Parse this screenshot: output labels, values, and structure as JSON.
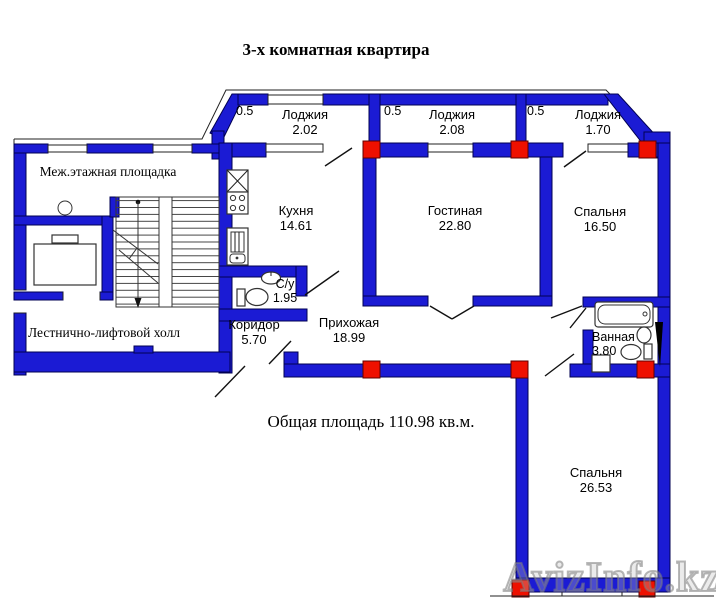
{
  "title": "3-х комнатная квартира",
  "total_area_text": "Общая площадь 110.98 кв.м.",
  "watermark": "AvizInfo.kz",
  "colors": {
    "wall": "#1b1bd4",
    "wall_border": "#000052",
    "column_marker": "#ee1000",
    "background": "#ffffff"
  },
  "rooms": {
    "lodzhia1": {
      "name": "Лоджия",
      "area": "2.02",
      "parapet": "0.5"
    },
    "lodzhia2": {
      "name": "Лоджия",
      "area": "2.08",
      "parapet": "0.5"
    },
    "lodzhia3": {
      "name": "Лоджия",
      "area": "1.70",
      "parapet": "0.5"
    },
    "kitchen": {
      "name": "Кухня",
      "area": "14.61"
    },
    "living": {
      "name": "Гостиная",
      "area": "22.80"
    },
    "bedroom1": {
      "name": "Спальня",
      "area": "16.50"
    },
    "wc": {
      "name": "С/у",
      "area": "1.95"
    },
    "corridor": {
      "name": "Коридор",
      "area": "5.70"
    },
    "hallway": {
      "name": "Прихожая",
      "area": "18.99"
    },
    "bathroom": {
      "name": "Ванная",
      "area": "3.80"
    },
    "bedroom2": {
      "name": "Спальня",
      "area": "26.53"
    },
    "landing": {
      "name": "Меж.этажная площадка"
    },
    "hall": {
      "name": "Лестнично-лифтовой холл"
    }
  }
}
